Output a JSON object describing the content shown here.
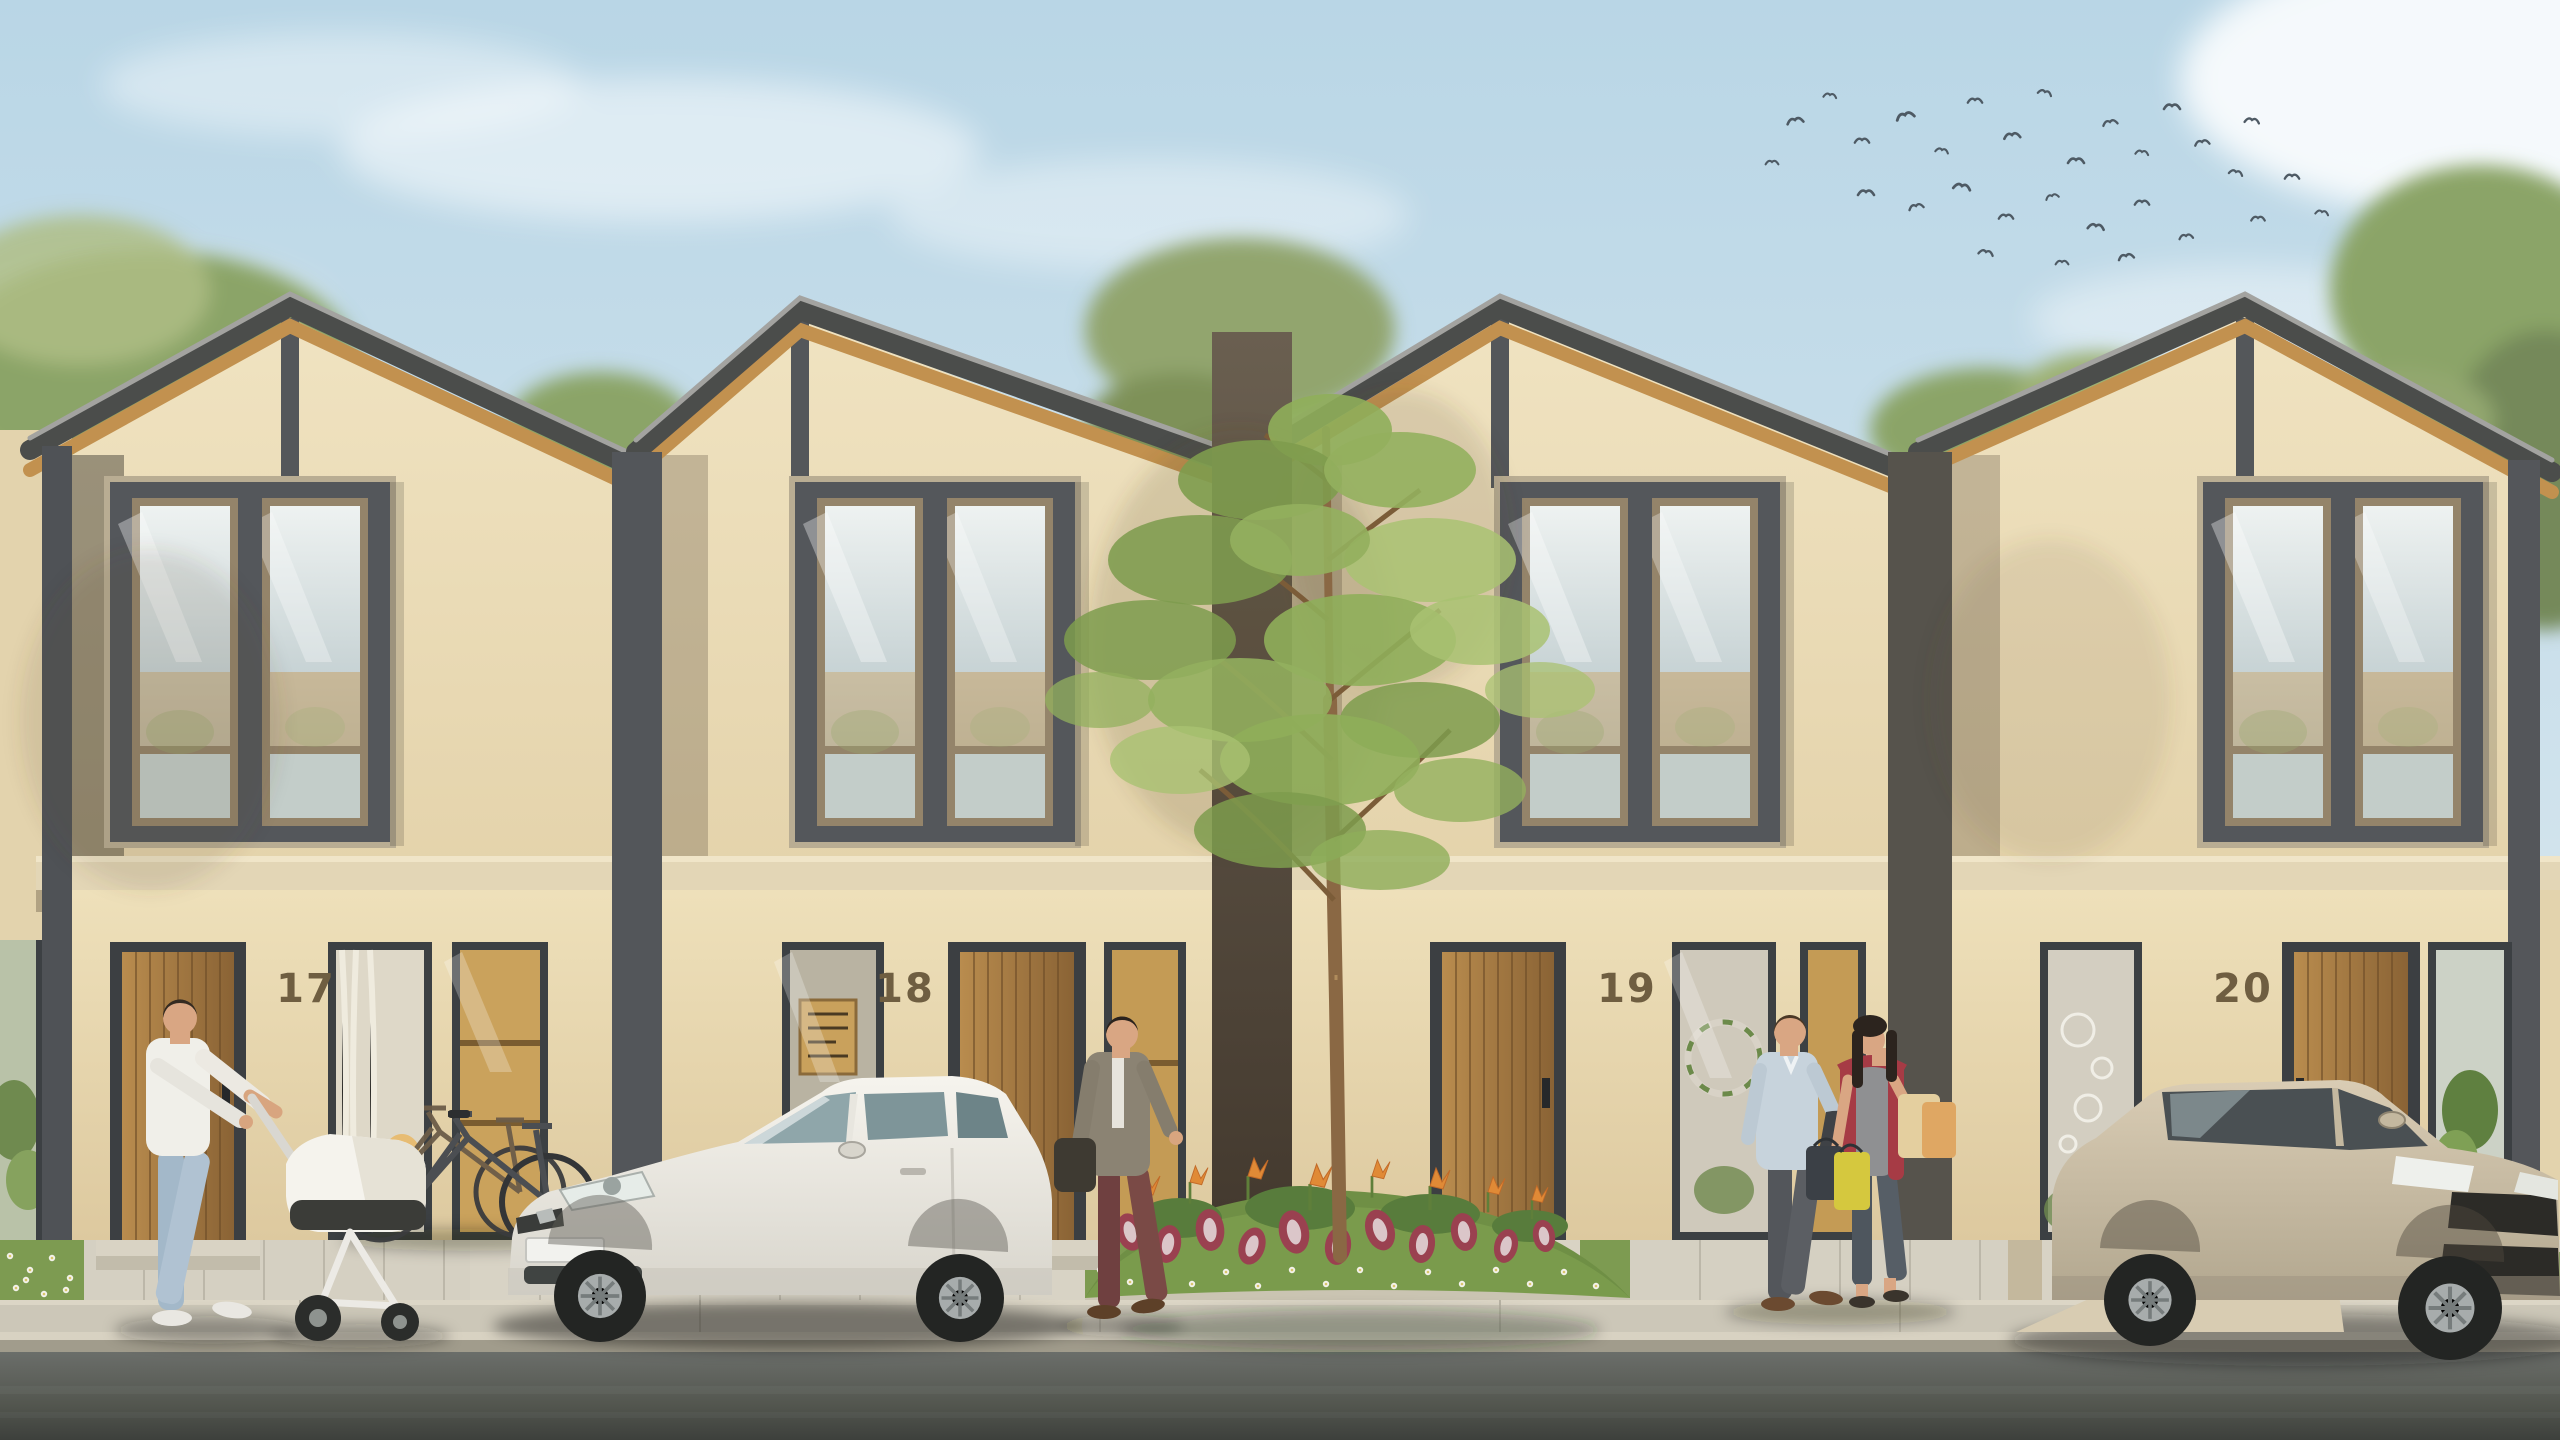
{
  "scene": {
    "title": "Modern townhouse row — daytime exterior architectural render",
    "setting": "Street-front elevation of four attached two-storey houses with asymmetric gable roofs, wooden soffits, beige stucco walls, parked cars, pedestrians, central garden tree and a flock of birds in the sky"
  },
  "houses": [
    {
      "number": "17",
      "door_side": "left",
      "frontage": "walkway with two parked bicycles"
    },
    {
      "number": "18",
      "door_side": "right",
      "frontage": "driveway with white hatchback car"
    },
    {
      "number": "19",
      "door_side": "left",
      "frontage": "paved apron, couple with shopping bags"
    },
    {
      "number": "20",
      "door_side": "right",
      "frontage": "driveway with beige sedan"
    }
  ],
  "foreground": {
    "pedestrians": [
      {
        "id": "man-with-stroller",
        "clothing": "white polo shirt, light blue jeans",
        "activity": "pushing white baby stroller"
      },
      {
        "id": "man-in-cardigan",
        "clothing": "grey cardigan, maroon trousers",
        "activity": "walking behind white car carrying a bag"
      },
      {
        "id": "couple-shopping",
        "clothing": "man in light blue shirt, woman in red cardigan with grey top",
        "activity": "walking with yellow, black and beige shopping bags"
      }
    ],
    "vehicles": [
      {
        "id": "white-hatchback",
        "color": "#f1efe8",
        "position": "driveway of house 18"
      },
      {
        "id": "beige-sedan",
        "color": "#cfc2ab",
        "position": "driveway of house 20"
      }
    ],
    "garden": {
      "tree": "young ornamental tree in central bed",
      "plants": "red-white caladium, orange bird-of-paradise flowers, white ground flowers, lawn"
    },
    "sky": {
      "birds": "flock of small birds upper right",
      "clouds": "soft white clouds on pale blue sky"
    }
  },
  "palette": {
    "sky_top": "#bdd8e6",
    "sky_low": "#e2edf1",
    "wall_beige": "#ead9b5",
    "wall_light": "#f0e4c4",
    "roof_fascia": "#4b4d4b",
    "soffit_wood": "#c2914f",
    "window_dark_frame": "#54575a",
    "window_tan_frame": "#94846a",
    "door_wood": "#a5793f",
    "number_color": "#6f5e41",
    "lawn_green": "#7d9b51",
    "paving": "#d6d1c3",
    "sidewalk": "#ccc7b8",
    "asphalt": "#5d605c",
    "bird_grey": "#4e5a64"
  }
}
